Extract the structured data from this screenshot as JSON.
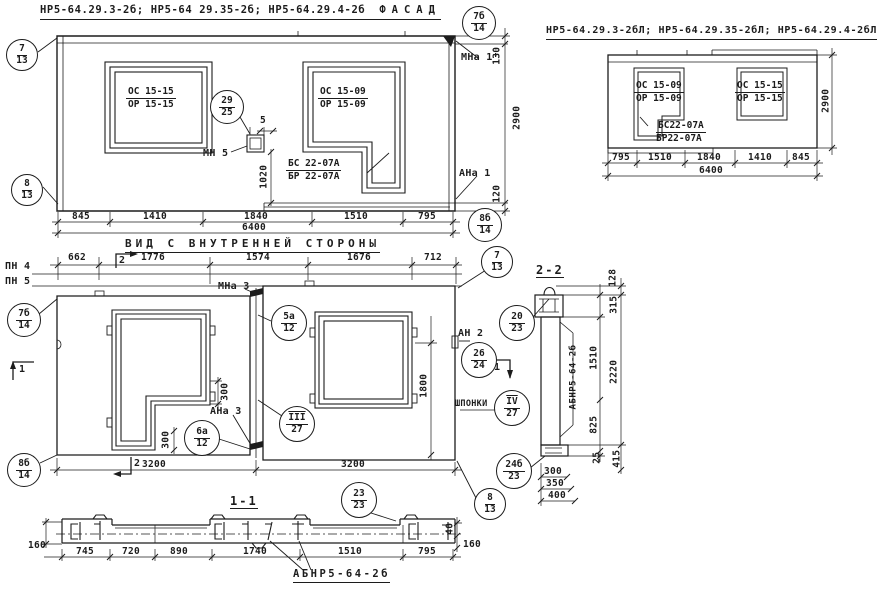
{
  "canvas": {
    "width": 877,
    "height": 594,
    "ink": "#1c1c1c",
    "paper": "#ffffff"
  },
  "fasad_left": {
    "title_codes": "НР5-64.29.3-2б; НР5-64 29.35-2б; НР5-64.29.4-2б",
    "title_view": "ФАСАД",
    "window_left_mark": {
      "top": "ОС 15-15",
      "bottom": "ОР 15-15"
    },
    "window_right_mark": {
      "top": "ОС 15-09",
      "bottom": "ОР 15-09"
    },
    "beam_mark": {
      "top": "БС 22-07А",
      "bottom": "БР 22-07А"
    },
    "label_mn5": "МН 5",
    "label_mna1": "МНа 1'",
    "label_ana1": "АНа 1",
    "dim_gap": "5",
    "dim_1020": "1020",
    "dim_130": "130",
    "dim_2900": "2900",
    "dim_120": "120",
    "dims_bottom": [
      "845",
      "1410",
      "1840",
      "1510",
      "795"
    ],
    "dim_total": "6400",
    "callout_7_13": {
      "top": "7",
      "bottom": "13"
    },
    "callout_8_13": {
      "top": "8",
      "bottom": "13"
    },
    "callout_29_25": {
      "top": "29",
      "bottom": "25"
    },
    "callout_7b_14": {
      "top": "7б",
      "bottom": "14"
    },
    "callout_8b_14": {
      "top": "8б",
      "bottom": "14"
    }
  },
  "fasad_right": {
    "title_codes": "НР5-64.29.3-2бЛ; НР5-64.29.35-2бЛ; НР5-64.29.4-2бЛ",
    "title_view": "ФАСАД",
    "window_left_mark": {
      "top": "ОС 15-09",
      "bottom": "ОР 15-09"
    },
    "window_right_mark": {
      "top": "ОС 15-15",
      "bottom": "ОР 15-15"
    },
    "beam_mark": {
      "top": "БС22-07А",
      "bottom": "БР22-07А"
    },
    "dims_bottom": [
      "795",
      "1510",
      "1840",
      "1410",
      "845"
    ],
    "dim_total": "6400",
    "dim_height": "2900"
  },
  "inner_view": {
    "title": "ВИД С ВНУТРЕННЕЙ СТОРОНЫ",
    "label_pn4": "ПН 4",
    "label_pn5": "ПН 5",
    "label_mna3": "МНа 3",
    "label_ana3": "АНа 3",
    "label_an2": "АН 2",
    "label_shponki": "ШПОНКИ",
    "marker_1": "1",
    "marker_2": "2",
    "dims_top": [
      "662",
      "1776",
      "1574",
      "1676",
      "712"
    ],
    "dims_bottom": [
      "3200",
      "3200"
    ],
    "dim_1800": "1800",
    "dim_300_step": "300",
    "dim_300_bottom": "300",
    "callout_7_13": {
      "top": "7",
      "bottom": "13"
    },
    "callout_7b_14": {
      "top": "7б",
      "bottom": "14"
    },
    "callout_8b_14": {
      "top": "8б",
      "bottom": "14"
    },
    "callout_8_13": {
      "top": "8",
      "bottom": "13"
    },
    "callout_5a_12": {
      "top": "5а",
      "bottom": "12"
    },
    "callout_6a_12": {
      "top": "6а",
      "bottom": "12"
    },
    "callout_iii_27": {
      "top": "III",
      "bottom": "27"
    },
    "callout_iv_27": {
      "top": "IV",
      "bottom": "27"
    },
    "callout_26_24": {
      "top": "26",
      "bottom": "24"
    },
    "callout_20_23": {
      "top": "20",
      "bottom": "23"
    },
    "callout_24b_23": {
      "top": "24б",
      "bottom": "23"
    }
  },
  "section_2_2": {
    "title": "2-2",
    "panel_mark": "АБНР5-64-2б",
    "dim_128": "128",
    "dim_315": "315",
    "dim_1510": "1510",
    "dim_2220": "2220",
    "dim_825": "825",
    "dim_25": "25",
    "dim_415": "415",
    "dims_bottom": [
      "300",
      "350",
      "400"
    ]
  },
  "section_1_1": {
    "title": "1-1",
    "callout_23_23": {
      "top": "23",
      "bottom": "23"
    },
    "panel_mark": "АБНР5-64-2б",
    "dim_left_160": "160",
    "dim_40": "40",
    "dim_right_160": "160",
    "dims_bottom": [
      "745",
      "720",
      "890",
      "1740",
      "1510",
      "795"
    ]
  }
}
